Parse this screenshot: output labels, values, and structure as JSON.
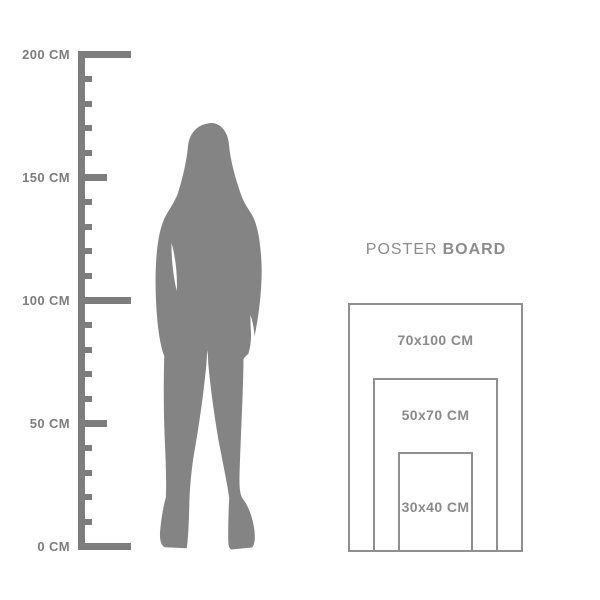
{
  "page": {
    "background_color": "#ffffff"
  },
  "ruler": {
    "unit": "CM",
    "min_cm": 0,
    "max_cm": 200,
    "major_step_cm": 50,
    "minor_step_cm": 10,
    "color": "#7d7d7d",
    "label_color": "#7d7d7d",
    "labels": [
      {
        "cm": 200,
        "text": "200 CM"
      },
      {
        "cm": 150,
        "text": "150 CM"
      },
      {
        "cm": 100,
        "text": "100 CM"
      },
      {
        "cm": 50,
        "text": "50 CM"
      },
      {
        "cm": 0,
        "text": "0 CM"
      }
    ]
  },
  "figure": {
    "color": "#848484"
  },
  "poster_board": {
    "title_regular": "POSTER",
    "title_bold": "BOARD",
    "title_color": "#8c8c8c",
    "border_color": "#8f8f8f",
    "label_color": "#8a8a8a",
    "sizes": [
      {
        "label": "70x100 CM",
        "width_cm": 70,
        "height_cm": 100
      },
      {
        "label": "50x70 CM",
        "width_cm": 50,
        "height_cm": 70
      },
      {
        "label": "30x40 CM",
        "width_cm": 30,
        "height_cm": 40
      }
    ]
  }
}
